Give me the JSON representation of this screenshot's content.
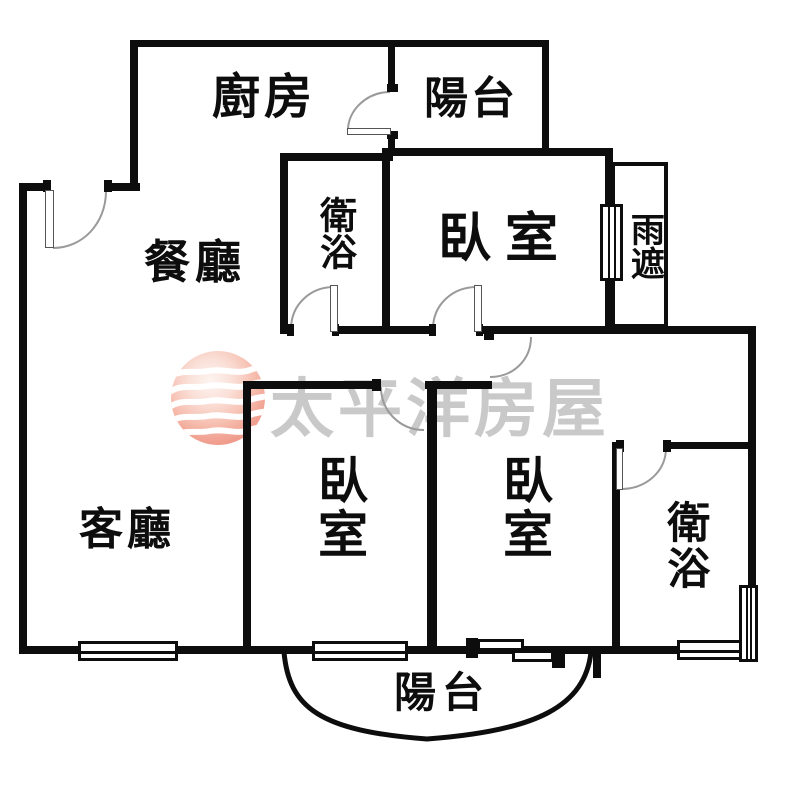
{
  "floorplan": {
    "background_color": "#ffffff",
    "wall_color": "#0d0d0d",
    "door_arc_color": "#9a9a9a",
    "rooms": [
      {
        "id": "kitchen",
        "label": "廚房"
      },
      {
        "id": "balcony-top",
        "label": "陽台"
      },
      {
        "id": "dining-room",
        "label": "餐廳"
      },
      {
        "id": "bathroom-top",
        "label": "衛浴"
      },
      {
        "id": "bedroom-top",
        "label": "臥室"
      },
      {
        "id": "rain-cover",
        "label": "雨遮"
      },
      {
        "id": "living-room",
        "label": "客廳"
      },
      {
        "id": "bedroom-left",
        "label": "臥室"
      },
      {
        "id": "bedroom-middle",
        "label": "臥室"
      },
      {
        "id": "bathroom-bottom",
        "label": "衛浴"
      },
      {
        "id": "balcony-bottom",
        "label": "陽台"
      }
    ],
    "watermark": {
      "text": "太平洋房屋",
      "text_color": "#c9c9c9",
      "logo_colors": {
        "center": "#fdf4f0",
        "mid": "#f7c4b6",
        "edge": "#ec8d7e",
        "waves": "#ffffff"
      }
    }
  }
}
